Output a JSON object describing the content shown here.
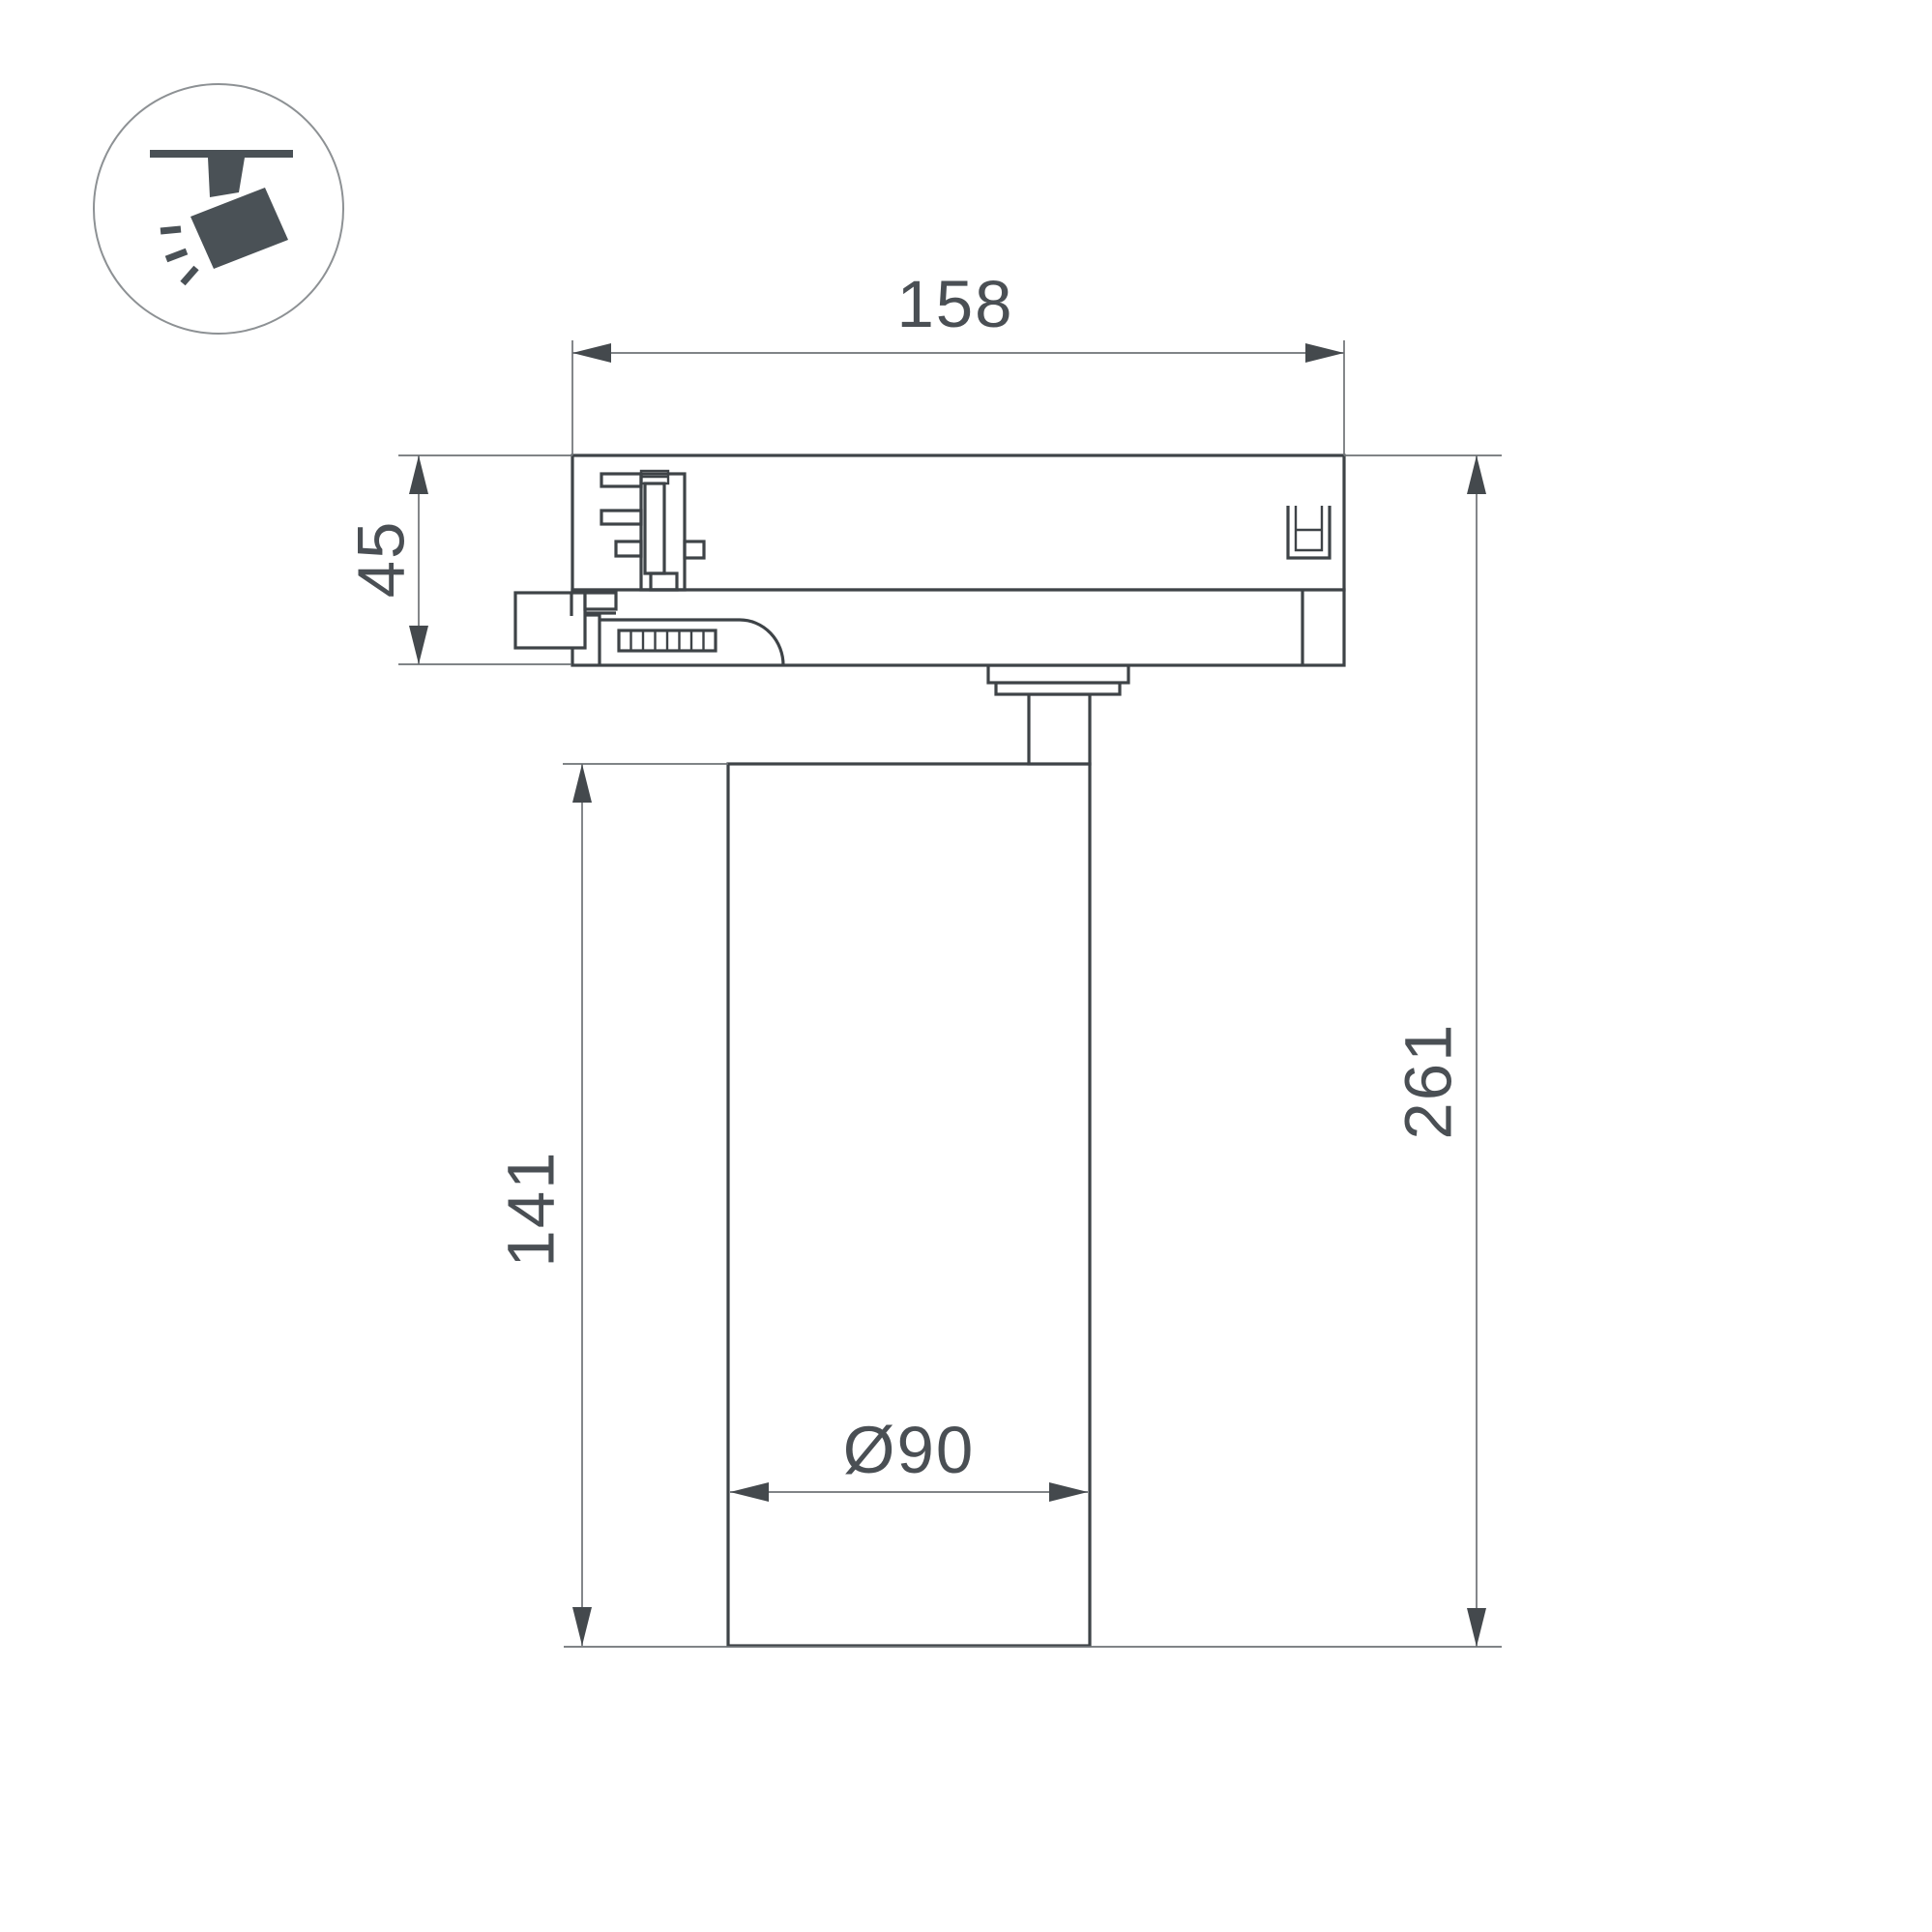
{
  "drawing": {
    "kind": "technical dimension drawing",
    "subject": "track-mounted spotlight, side view",
    "icon": "track-spotlight-icon",
    "dimensions": {
      "adapter_width": "158",
      "adapter_height": "45",
      "body_height": "141",
      "total_height": "261",
      "body_diameter": "Ø90"
    },
    "colors": {
      "outline": "#3e4347",
      "dimension_line": "#6e7276",
      "arrow": "#44494d",
      "text": "#4a4f54",
      "icon": "#4a5156",
      "circle_stroke": "#8d9194",
      "background": "#ffffff"
    }
  }
}
